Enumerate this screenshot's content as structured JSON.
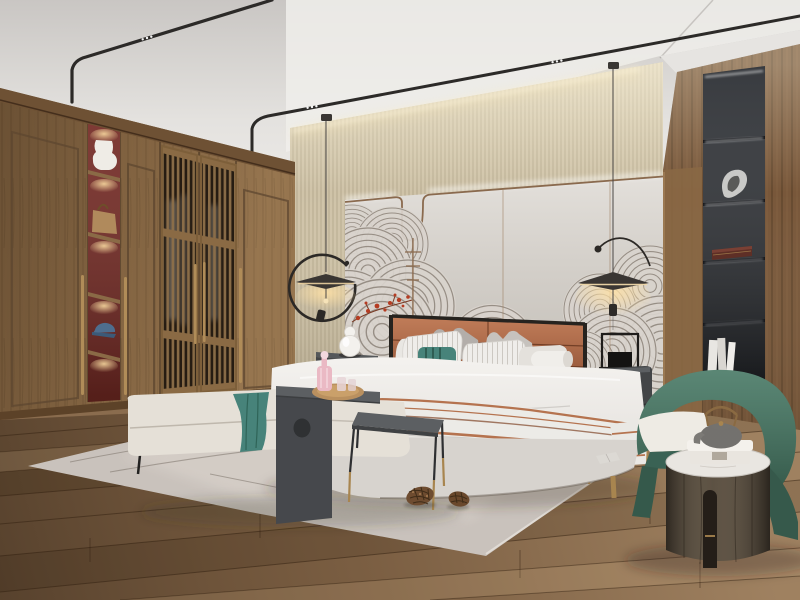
{
  "scene": {
    "type": "photorealistic-interior-render",
    "room": "modern new-chinese style bedroom",
    "counts": {
      "pendant_lamps": 2,
      "pine_cones": 2,
      "black_niche_shelves": 4,
      "wardrobe_display_shelves": 5
    },
    "objects": [
      {
        "name": "ceiling-light-track",
        "desc": "two thin black magnetic light tracks curving from ceiling down to wardrobe, tiny white spot lights"
      },
      {
        "name": "pendant-lamp-left",
        "desc": "black flat-disc pendant with open C-ring arm, warm under-glow"
      },
      {
        "name": "pendant-lamp-right",
        "desc": "black flat-disc pendant with curved ball-end arm, warm under-glow"
      },
      {
        "name": "wardrobe",
        "desc": "full-height walnut wardrobe with framed doors and long brass pulls"
      },
      {
        "name": "wardrobe-display-column",
        "desc": "narrow open shelving with red back, lit shelves holding white vase, tan handbag, blue cap"
      },
      {
        "name": "lattice-doors",
        "desc": "two vertical-slat wood screen doors with closet interior behind"
      },
      {
        "name": "headboard-feature-wall",
        "desc": "cream wall panels with bronze trim (U-dip), LED cove light, grey ink wave mural"
      },
      {
        "name": "red-blossom-decor",
        "desc": "small red blossom sprigs over the mural and a thin bronze stem"
      },
      {
        "name": "bed",
        "desc": "upholstered platform bed, cognac leather panelled headboard with black trim"
      },
      {
        "name": "bedding",
        "desc": "white duvet, grey and striped pillows, teal accent pillow, white bolster, terracotta striped runner"
      },
      {
        "name": "nightstand-left",
        "desc": "dark cabinet with white gourd table lamp"
      },
      {
        "name": "nightstand-right",
        "desc": "grey rounded cabinet with brass pulls, brass legs, black lantern decor"
      },
      {
        "name": "bench",
        "desc": "cream bench at foot of bed with teal throw"
      },
      {
        "name": "waterfall-side-table",
        "desc": "dark grey C-shaped table with round cutout"
      },
      {
        "name": "serving-tray",
        "desc": "round wood tray with pink decanter and glasses"
      },
      {
        "name": "pouf",
        "desc": "cream square ottoman"
      },
      {
        "name": "small-console-table",
        "desc": "dark-top table with thin legs and brass feet"
      },
      {
        "name": "area-rug",
        "desc": "pale greige rug with thin line motif and charcoal edge band"
      },
      {
        "name": "pine-cones",
        "desc": "two pine cones lying on the rug"
      },
      {
        "name": "armchair",
        "desc": "green barrel armchair with white seat cushion and sculpted legs"
      },
      {
        "name": "drum-side-table",
        "desc": "dark wood cylinder table, white marble top, slot cutout, brass detail"
      },
      {
        "name": "teapot-and-box",
        "desc": "grey clay teapot with brass swing handle on a white gift box"
      },
      {
        "name": "display-niche",
        "desc": "black recessed shelf column with LED strips: silver sculpture, dark red box, white books"
      },
      {
        "name": "wood-accent-wall",
        "desc": "walnut plank wall on the right side"
      },
      {
        "name": "wood-floor",
        "desc": "wide oak planks running diagonally"
      }
    ]
  },
  "palette": {
    "ceiling": "#e2e0dd",
    "wall_beige": "#cbbfa4",
    "feature_wall": "#d6d1ca",
    "trim_bronze": "#8a6a4e",
    "art_line": "#877e74",
    "blossom_red": "#b53c22",
    "wardrobe_wood": "#8a6a46",
    "niche_red": "#752a24",
    "brass": "#b08c58",
    "leather": "#a65c3a",
    "bed_base": "#d7d3ce",
    "teal": "#47837a",
    "terracotta": "#b5734f",
    "nightstand_dark": "#434547",
    "bench_cream": "#e5e0d7",
    "table_grey": "#5c5f62",
    "tray_wood": "#b9905f",
    "decanter_pink": "#eab9c4",
    "rug": "#c9c2bc",
    "rug_band": "#3b3733",
    "floor_wood": "#8a6c4e",
    "chair_green": "#3e6a59",
    "cushion_white": "#eeebe4",
    "side_table_wood": "#4a4034",
    "marble": "#e9e6e1",
    "teapot_grey": "#85837f",
    "shelf_black": "#22252a",
    "wood_wall": "#78573a",
    "pinecone": "#6e4c30",
    "lattice_dark": "#261c12"
  }
}
